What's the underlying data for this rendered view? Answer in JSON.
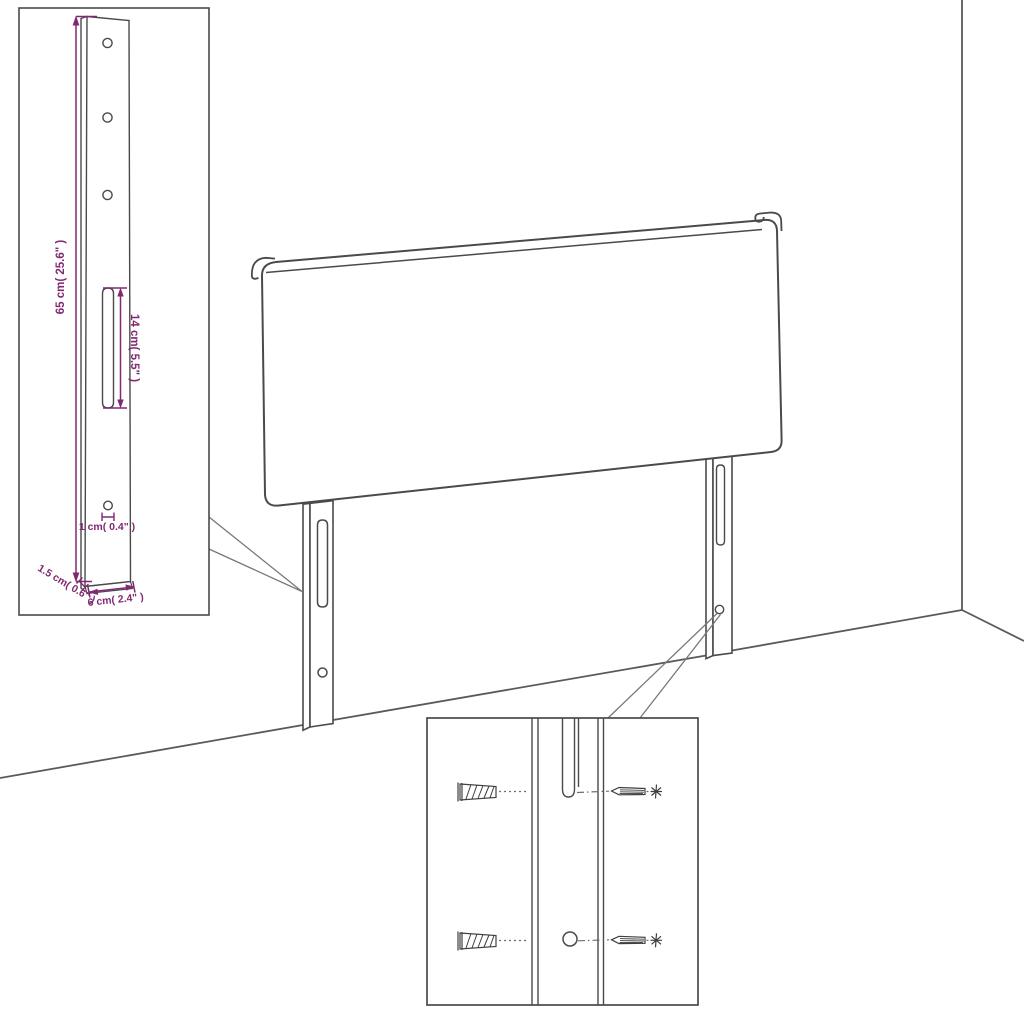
{
  "colors": {
    "background": "#ffffff",
    "outline": "#4a4a4a",
    "dimension": "#822873",
    "callout": "#787878"
  },
  "leg_detail_inset": {
    "height_label": "65 cm( 25.6\" )",
    "slot_label": "14 cm( 5.5\" )",
    "hole_label": "1 cm( 0.4\" )",
    "thickness_label": "1.5 cm( 0.6\" )",
    "width_label": "6 cm( 2.4\" )"
  },
  "hardware_inset": {
    "icons": [
      {
        "name": "wall-anchor-icon",
        "count": 2
      },
      {
        "name": "screw-icon",
        "count": 2
      }
    ]
  }
}
